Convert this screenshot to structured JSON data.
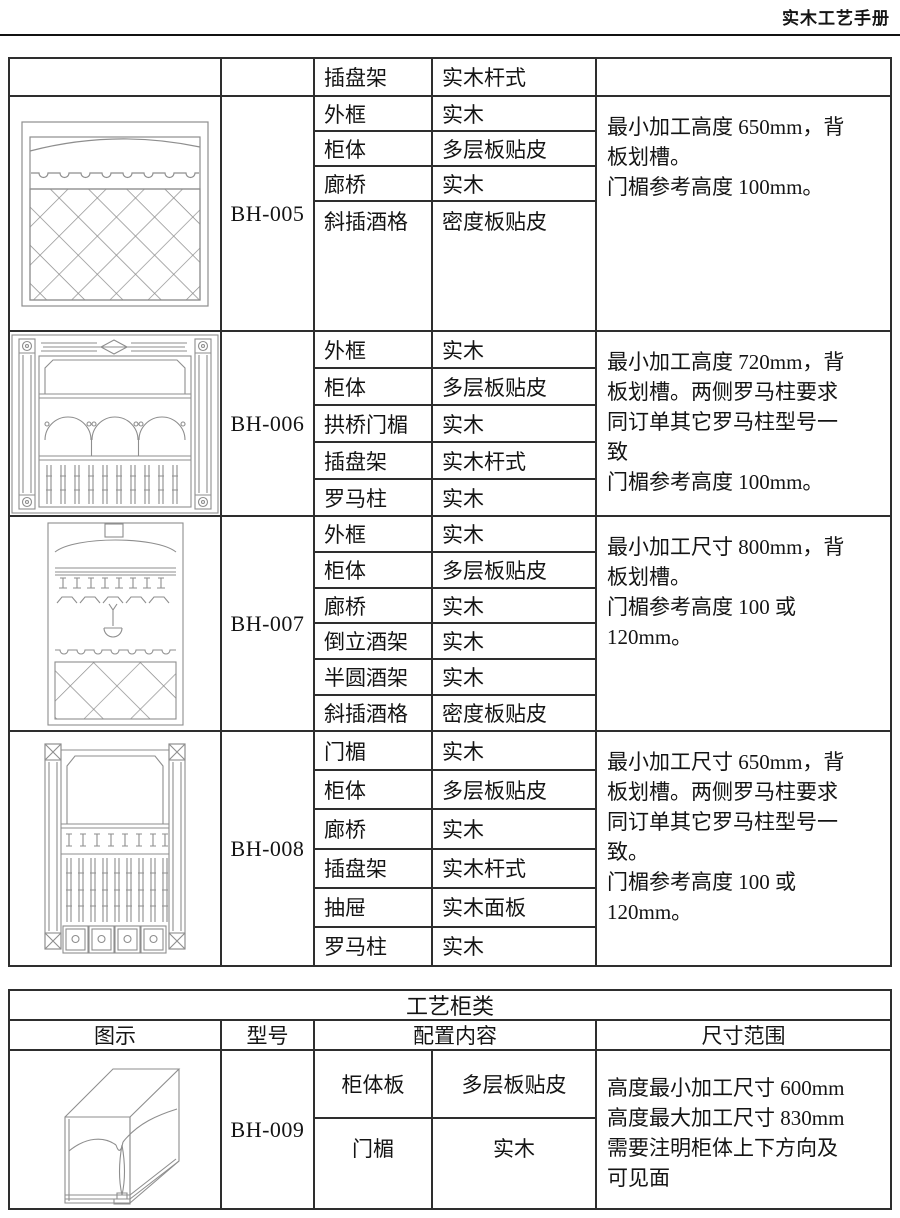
{
  "page_header": {
    "title": "实木工艺手册"
  },
  "main_table": {
    "carryover_row": {
      "part": "插盘架",
      "material": "实木杆式"
    },
    "products": [
      {
        "model": "BH-005",
        "diagram": "wine-cabinet-front-arched-top-scallop-band-diamond-lattice",
        "config": [
          {
            "part": "外框",
            "material": "实木"
          },
          {
            "part": "柜体",
            "material": "多层板贴皮"
          },
          {
            "part": "廊桥",
            "material": "实木"
          },
          {
            "part": "斜插酒格",
            "material": "密度板贴皮"
          }
        ],
        "note": "最小加工高度 650mm，背\n板划槽。\n门楣参考高度 100mm。"
      },
      {
        "model": "BH-006",
        "diagram": "wine-cabinet-front-roman-columns-three-arches-balusters",
        "config": [
          {
            "part": "外框",
            "material": "实木"
          },
          {
            "part": "柜体",
            "material": "多层板贴皮"
          },
          {
            "part": "拱桥门楣",
            "material": "实木"
          },
          {
            "part": "插盘架",
            "material": "实木杆式"
          },
          {
            "part": "罗马柱",
            "material": "实木"
          }
        ],
        "note": "最小加工高度 720mm，背\n板划槽。两侧罗马柱要求\n同订单其它罗马柱型号一\n致\n门楣参考高度 100mm。"
      },
      {
        "model": "BH-007",
        "diagram": "wine-cabinet-front-stemware-rack-hanging-glass-diamond-lattice",
        "config": [
          {
            "part": "外框",
            "material": "实木"
          },
          {
            "part": "柜体",
            "material": "多层板贴皮"
          },
          {
            "part": "廊桥",
            "material": "实木"
          },
          {
            "part": "倒立酒架",
            "material": "实木"
          },
          {
            "part": "半圆酒架",
            "material": "实木"
          },
          {
            "part": "斜插酒格",
            "material": "密度板贴皮"
          }
        ],
        "note": "最小加工尺寸 800mm，背\n板划槽。\n门楣参考高度 100 或\n120mm。"
      },
      {
        "model": "BH-008",
        "diagram": "wine-cabinet-front-columns-balusters-four-drawers",
        "config": [
          {
            "part": "门楣",
            "material": "实木"
          },
          {
            "part": "柜体",
            "material": "多层板贴皮"
          },
          {
            "part": "廊桥",
            "material": "实木"
          },
          {
            "part": "插盘架",
            "material": "实木杆式"
          },
          {
            "part": "抽屉",
            "material": "实木面板"
          },
          {
            "part": "罗马柱",
            "material": "实木"
          }
        ],
        "note": "最小加工尺寸 650mm，背\n板划槽。两侧罗马柱要求\n同订单其它罗马柱型号一\n致。\n门楣参考高度 100 或\n120mm。"
      }
    ]
  },
  "craft_table": {
    "title": "工艺柜类",
    "headers": {
      "diagram": "图示",
      "model": "型号",
      "config": "配置内容",
      "size_range": "尺寸范围"
    },
    "products": [
      {
        "model": "BH-009",
        "diagram": "cabinet-box-perspective-arched-lintel-spindle",
        "config": [
          {
            "part": "柜体板",
            "material": "多层板贴皮"
          },
          {
            "part": "门楣",
            "material": "实木"
          }
        ],
        "note": "高度最小加工尺寸 600mm\n高度最大加工尺寸 830mm\n需要注明柜体上下方向及\n可见面"
      }
    ]
  }
}
